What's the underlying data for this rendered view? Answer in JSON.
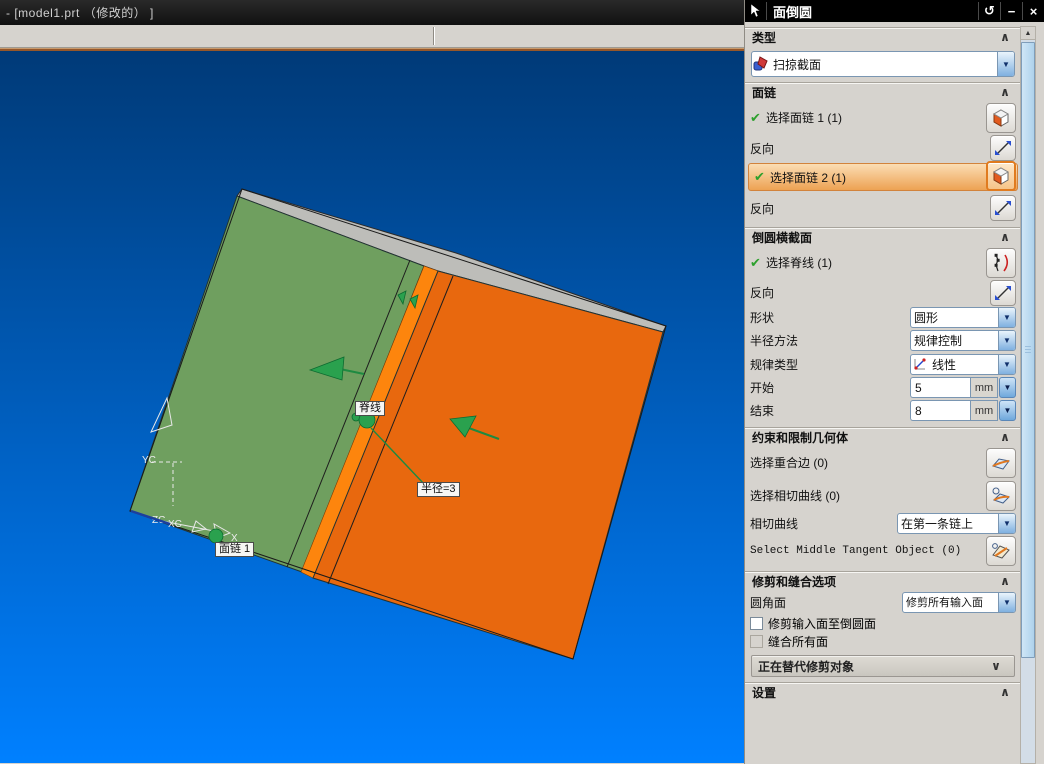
{
  "window": {
    "title": "- [model1.prt （修改的） ]"
  },
  "dialog": {
    "title": "面倒圆",
    "type_section": {
      "header": "类型",
      "value": "扫掠截面"
    },
    "face_chain": {
      "header": "面链",
      "select_chain1": "选择面链 1 (1)",
      "reverse1": "反向",
      "select_chain2": "选择面链 2 (1)",
      "reverse2": "反向"
    },
    "cross_section": {
      "header": "倒圆横截面",
      "select_spine": "选择脊线 (1)",
      "reverse": "反向",
      "shape_label": "形状",
      "shape_value": "圆形",
      "radius_method_label": "半径方法",
      "radius_method_value": "规律控制",
      "law_type_label": "规律类型",
      "law_type_value": "线性",
      "start_label": "开始",
      "start_value": "5",
      "start_unit": "mm",
      "end_label": "结束",
      "end_value": "8",
      "end_unit": "mm"
    },
    "constraints": {
      "header": "约束和限制几何体",
      "coincident_edge": "选择重合边 (0)",
      "tangent_curves": "选择相切曲线 (0)",
      "tangent_label": "相切曲线",
      "tangent_value": "在第一条链上",
      "middle_tangent": "Select Middle Tangent Object (0)"
    },
    "trim": {
      "header": "修剪和缝合选项",
      "fillet_face_label": "圆角面",
      "fillet_face_value": "修剪所有输入面",
      "checkbox_trim_input": "修剪输入面至倒圆面",
      "checkbox_sew_all": "缝合所有面",
      "collapsed_group": "正在替代修剪对象"
    },
    "settings": {
      "header": "设置"
    }
  },
  "viewport": {
    "spine_label": "脊线",
    "radius_label": "半径=3",
    "face_chain_label": "面链 1",
    "csys": {
      "yc": "YC",
      "zc": "ZC",
      "xc": "XC",
      "x": "X"
    }
  },
  "icons": {
    "check": "✔",
    "collapse": "∧",
    "expand": "∨",
    "reset": "↺",
    "minimize": "−",
    "close": "×",
    "up_arrow": "▲"
  },
  "colors": {
    "face-green": "#6f9f5f",
    "face-orange": "#e8680e",
    "stripe-orange": "#fd850d",
    "top-gray": "#bdbdb9",
    "vp-top": "#003a78",
    "vp-bottom": "#0080ff",
    "hl-top": "#fbddb4",
    "hl-bottom": "#eda253",
    "hl-border": "#d2833c",
    "dlg-bg": "#d6d3ce",
    "accent-line": "#96572a",
    "green-mark": "#2aa14e"
  }
}
